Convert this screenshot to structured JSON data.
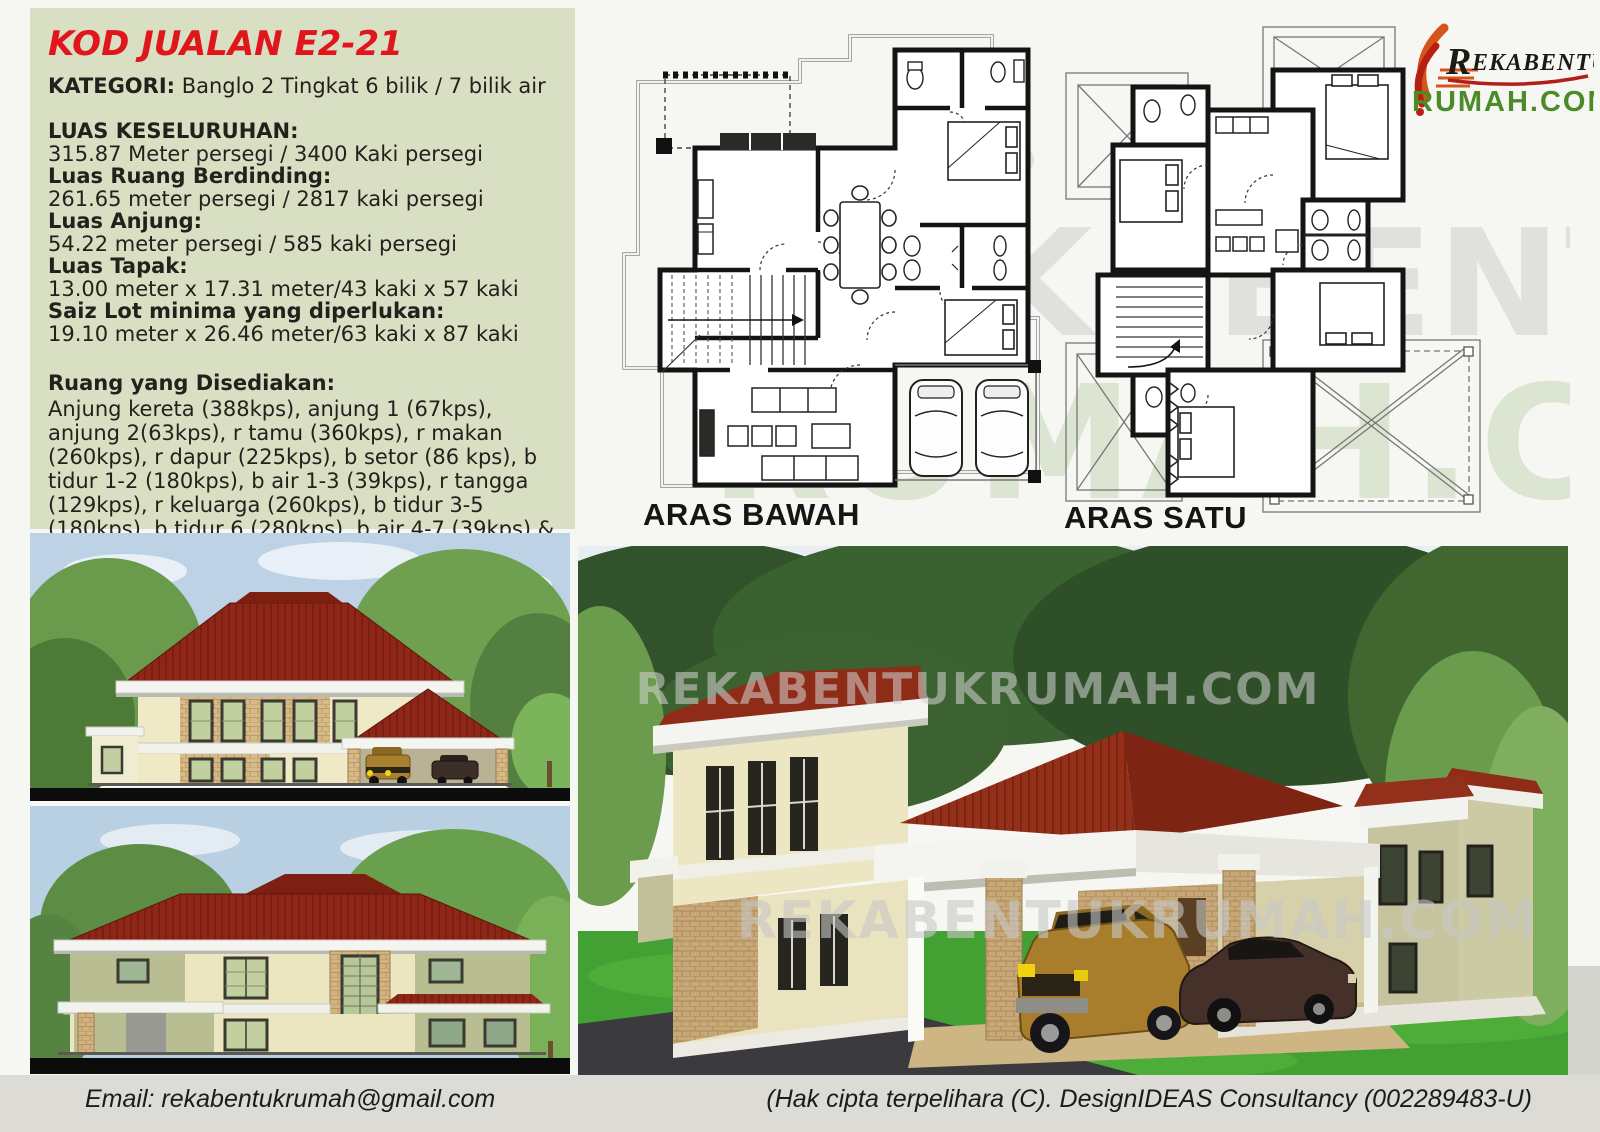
{
  "info": {
    "title": "KOD JUALAN E2-21",
    "kategori_label": "KATEGORI:",
    "kategori_value": " Banglo 2 Tingkat 6 bilik / 7 bilik air",
    "specs": [
      {
        "label": "LUAS KESELURUHAN:",
        "value": "315.87 Meter persegi / 3400 Kaki persegi"
      },
      {
        "label": "Luas Ruang Berdinding:",
        "value": "261.65 meter persegi / 2817 kaki persegi"
      },
      {
        "label": "Luas Anjung:",
        "value": "54.22 meter persegi / 585 kaki persegi"
      },
      {
        "label": "Luas Tapak:",
        "value": "13.00 meter x 17.31 meter/43 kaki x 57 kaki"
      },
      {
        "label": "Saiz Lot minima yang diperlukan:",
        "value": "19.10 meter x 26.46 meter/63 kaki x 87 kaki"
      }
    ],
    "ruang_label": "Ruang yang Disediakan:",
    "ruang_text": "Anjung kereta (388kps), anjung 1 (67kps), anjung 2(63kps), r tamu (360kps), r makan (260kps), r dapur (225kps), b setor (86 kps), b tidur 1-2 (180kps), b air 1-3 (39kps), r tangga (129kps), r keluarga (260kps), b tidur 3-5 (180kps), b tidur 6 (280kps), b air 4-7 (39kps) & balkoni (67kps)"
  },
  "plans": {
    "ground_label": "ARAS BAWAH",
    "first_label": "ARAS SATU"
  },
  "logo": {
    "initial": "R",
    "rest": "EKABENTUK",
    "domain": "RUMAH.COM"
  },
  "watermark": {
    "plans_line1": "REKABENTUK",
    "plans_line2": "RUMAH.COM",
    "render_text": "REKABENTUKRUMAH.COM"
  },
  "footer": {
    "email": "Email: rekabentukrumah@gmail.com",
    "copyright": "(Hak cipta terpelihara (C). DesignIDEAS Consultancy (002289483-U)"
  },
  "colors": {
    "panel_bg": "#d8dfc2",
    "title_red": "#e0161c",
    "logo_green": "#4c8c28",
    "roof_red": "#8f2618",
    "wall_cream": "#ece6c0",
    "wall_olive": "#b9bd92",
    "brick_tan": "#d2b280",
    "lawn_green": "#43a032",
    "sky_blue": "#bdd2e4",
    "footer_bg": "#dcdbd5"
  }
}
